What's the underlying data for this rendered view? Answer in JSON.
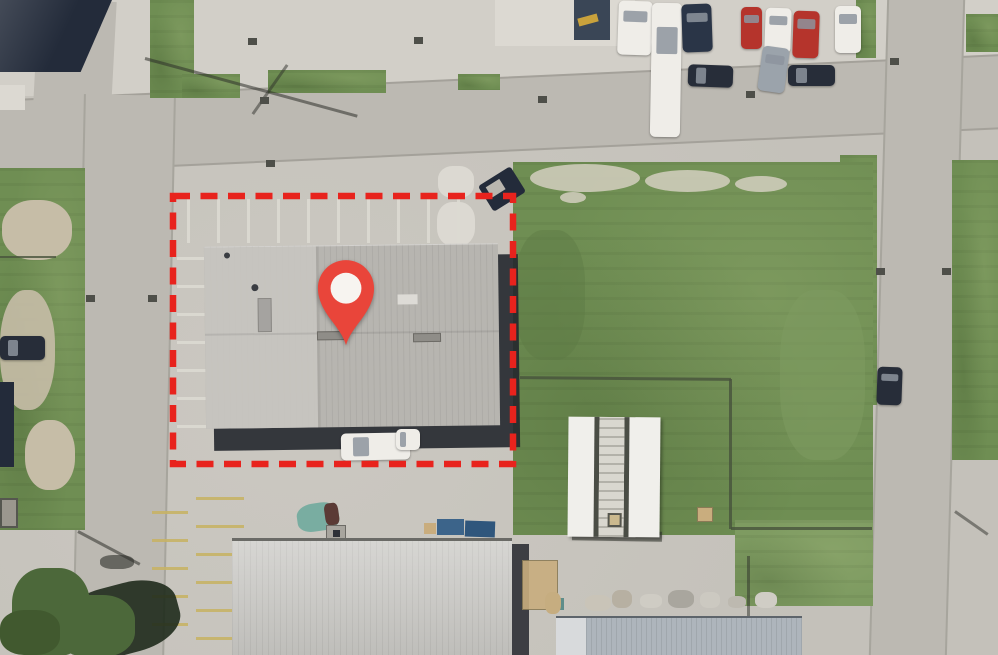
{
  "meta": {
    "view": "aerial-satellite-map",
    "description": "Satellite view of an industrial block; a red dashed boundary outlines a property with a large gray-roofed warehouse marked by a red location pin; grass field to the east, streets on three sides, parked cars along the north street"
  },
  "marker": {
    "icon": "location-pin",
    "color": "#e9453a",
    "dot_color": "#f7f4f0"
  },
  "boundary": {
    "style": "dashed",
    "color": "#e8231d",
    "rect": {
      "x": 173,
      "y": 196,
      "w": 340,
      "h": 268
    },
    "dash": "17 10.5",
    "thickness": 6.5
  },
  "colors": {
    "concrete": "#c7c4bd",
    "concreteLight": "#d2cfc8",
    "concretePale": "#dcd9d2",
    "road": "#bcb9b2",
    "curb": "#8a887f",
    "grass": "#6f8e53",
    "grassDark": "#5e7b45",
    "grassLight": "#7e9b61",
    "dirt": "#c6bda7",
    "mottle": "#d3cfbf",
    "roofMain": "#b7b5b0",
    "roofLight": "#c9c7c2",
    "roofBottom": "#c9c8c4",
    "roofBlue": "#aeb5bc",
    "shadow": "#24272e",
    "navyRoof": "#232b3a",
    "yellow": "#c7b266",
    "treeGreen": "#4c683a",
    "treeShadow": "#1f2b1c",
    "fence": "#47523c",
    "carWhite": "#efede8",
    "carDark": "#272d39",
    "carRed": "#b5342c",
    "carSilver": "#9ba3ab",
    "carBlueDark": "#2a3547",
    "glass": "#8d949e",
    "teal": "#79ada1",
    "maroon": "#5b3a35",
    "contBlue": "#3c648a",
    "tan": "#c9ad7e",
    "drain": "#4e4f49",
    "poleShadow": "#2d2f2a",
    "shedWhite": "#f0efeb",
    "shedGray": "#d9d7cf"
  },
  "scene": {
    "vehicles": [
      {
        "name": "white-rv-north",
        "color": "carWhite",
        "x": 618,
        "y": 1,
        "w": 34,
        "h": 54,
        "rot": 2
      },
      {
        "name": "white-trailer-north",
        "color": "carWhite",
        "x": 651,
        "y": 3,
        "w": 30,
        "h": 134,
        "rot": 1
      },
      {
        "name": "dark-suv-north",
        "color": "carBlueDark",
        "x": 682,
        "y": 4,
        "w": 30,
        "h": 48,
        "rot": -2
      },
      {
        "name": "red-pickup-north",
        "color": "carRed",
        "x": 741,
        "y": 7,
        "w": 21,
        "h": 42,
        "rot": 0
      },
      {
        "name": "white-car-north-1",
        "color": "carWhite",
        "x": 765,
        "y": 8,
        "w": 26,
        "h": 45,
        "rot": 2
      },
      {
        "name": "red-car-north",
        "color": "carRed",
        "x": 793,
        "y": 11,
        "w": 26,
        "h": 47,
        "rot": 2
      },
      {
        "name": "white-car-north-2",
        "color": "carWhite",
        "x": 835,
        "y": 6,
        "w": 26,
        "h": 47,
        "rot": 0
      },
      {
        "name": "dark-sedan-street-1",
        "color": "carDark",
        "x": 688,
        "y": 65,
        "w": 45,
        "h": 22,
        "rot": 2
      },
      {
        "name": "silver-car-street",
        "color": "carSilver",
        "x": 760,
        "y": 47,
        "w": 27,
        "h": 45,
        "rot": 8
      },
      {
        "name": "dark-sedan-street-2",
        "color": "carDark",
        "x": 788,
        "y": 65,
        "w": 47,
        "h": 21,
        "rot": 0
      },
      {
        "name": "dark-car-west",
        "color": "carDark",
        "x": 0,
        "y": 336,
        "w": 45,
        "h": 24,
        "rot": 0
      },
      {
        "name": "dark-car-east-road",
        "color": "carDark",
        "x": 877,
        "y": 367,
        "w": 25,
        "h": 38,
        "rot": 2
      },
      {
        "name": "white-van-at-building",
        "color": "carWhite",
        "x": 341,
        "y": 433,
        "w": 69,
        "h": 27,
        "rot": -1
      },
      {
        "name": "white-car-at-building",
        "color": "carWhite",
        "x": 396,
        "y": 429,
        "w": 24,
        "h": 21,
        "rot": 0
      }
    ],
    "drains": [
      [
        248,
        38
      ],
      [
        414,
        37
      ],
      [
        260,
        97
      ],
      [
        266,
        160
      ],
      [
        746,
        91
      ],
      [
        876,
        268
      ],
      [
        942,
        268
      ],
      [
        86,
        295
      ],
      [
        148,
        295
      ],
      [
        890,
        58
      ],
      [
        538,
        96
      ]
    ],
    "stripes": [
      {
        "name": "north-parking-stripes",
        "axis": "v",
        "x0": 187,
        "y0": 199,
        "dx": 30,
        "dy": 0,
        "count": 10,
        "w": 2.5,
        "h": 44,
        "color": "concretePale"
      },
      {
        "name": "west-parking-stripes",
        "axis": "h",
        "x0": 177,
        "y0": 257,
        "dx": 0,
        "dy": 28,
        "count": 7,
        "w": 66,
        "h": 2.5,
        "color": "concretePale"
      },
      {
        "name": "south-yellow-stripes-a",
        "axis": "h",
        "x0": 196,
        "y0": 497,
        "dx": 0,
        "dy": 28,
        "count": 6,
        "w": 48,
        "h": 3,
        "color": "yellow"
      },
      {
        "name": "south-yellow-stripes-b",
        "axis": "h",
        "x0": 152,
        "y0": 511,
        "dx": 0,
        "dy": 28,
        "count": 5,
        "w": 36,
        "h": 3,
        "color": "yellow"
      }
    ]
  }
}
